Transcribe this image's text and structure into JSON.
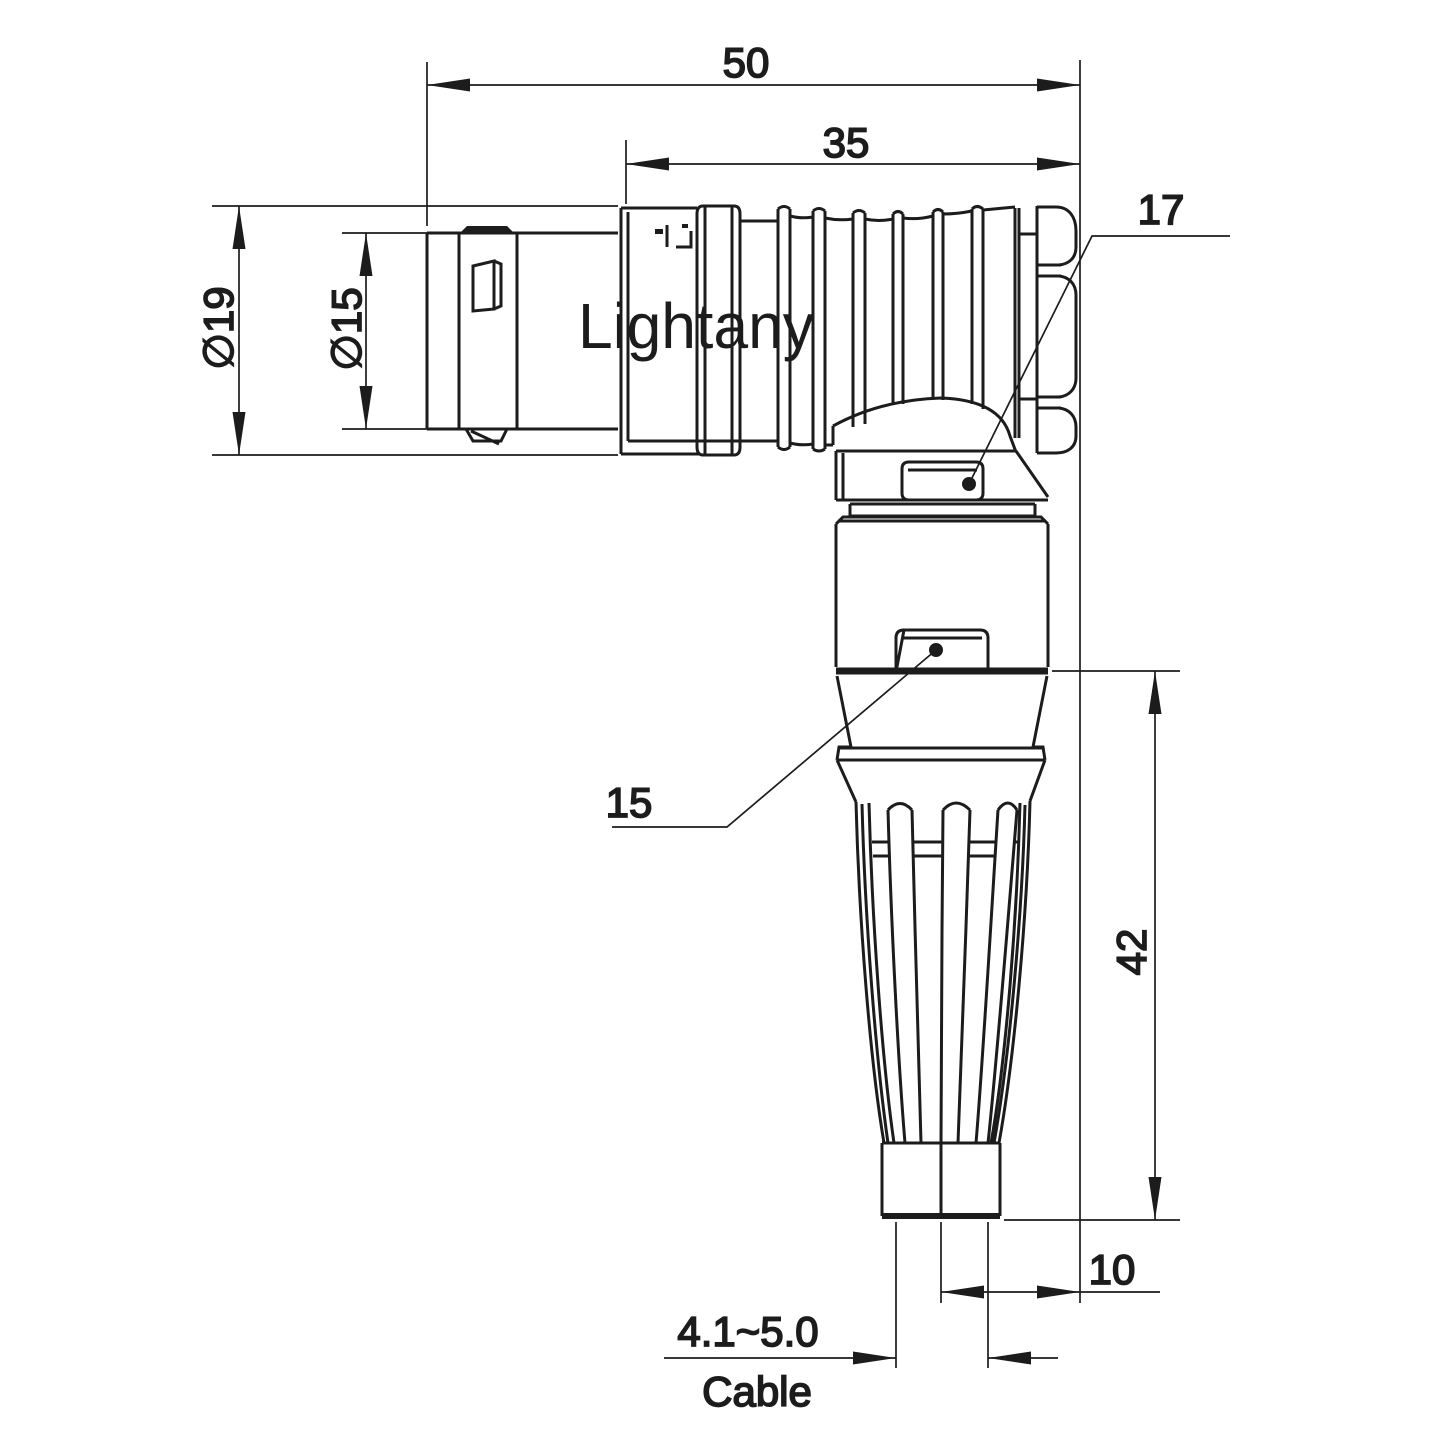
{
  "page": {
    "background": "#ffffff"
  },
  "watermark": {
    "text": "Lightany",
    "color": "#f5d9d9"
  },
  "colors": {
    "line": "#1c1c1c"
  },
  "labels": {
    "overall_length": "50",
    "boot_length": "35",
    "nut_ref": "17",
    "body_ref": "15",
    "outer_dia": "∅19",
    "plug_dia": "∅15",
    "vertical_len": "42",
    "exit_offset": "10",
    "cable_range": "4.1~5.0",
    "cable_word": "Cable"
  }
}
